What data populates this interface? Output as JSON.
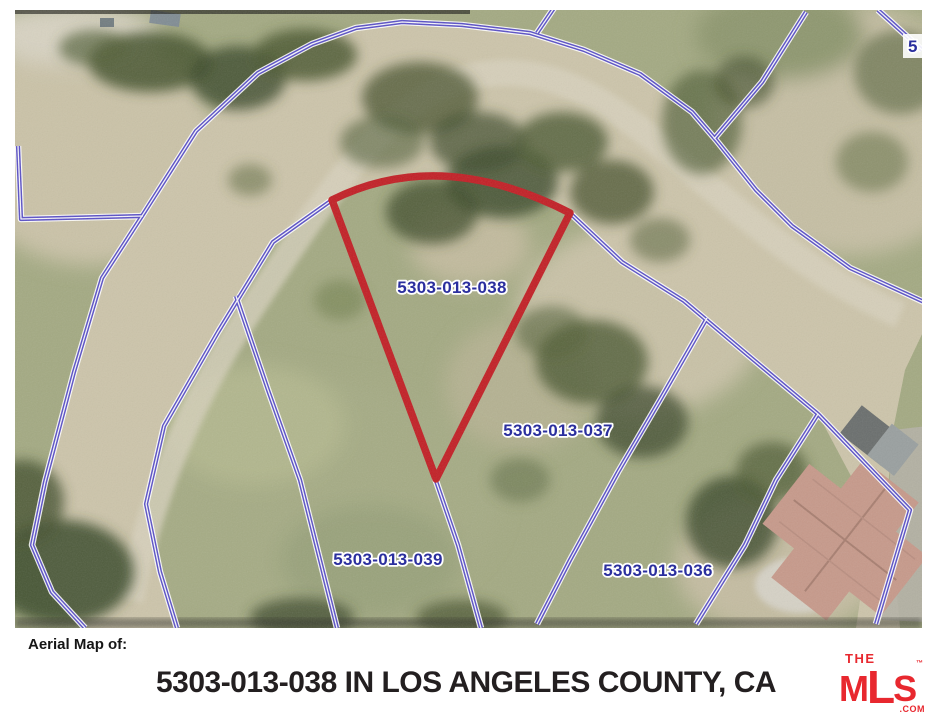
{
  "map": {
    "type": "aerial-parcel-map",
    "highlighted_parcel": "5303-013-038",
    "parcel_labels": [
      {
        "text": "5303-013-038",
        "highlighted": true
      },
      {
        "text": "5303-013-037",
        "highlighted": false
      },
      {
        "text": "5303-013-039",
        "highlighted": false
      },
      {
        "text": "5303-013-036",
        "highlighted": false
      },
      {
        "text": "5",
        "partial": true
      }
    ]
  },
  "footer": {
    "caption": "Aerial Map of:",
    "title": "5303-013-038 IN LOS ANGELES COUNTY, CA"
  },
  "logo": {
    "line1": "THE",
    "m": "M",
    "l": "L",
    "s": "S",
    "tm": "™",
    "suffix": ".COM"
  },
  "colors": {
    "parcel_line": "#5a50c6",
    "highlight_outline": "#c22026",
    "parcel_label": "#2b2f9e",
    "title_text": "#231f20",
    "logo_red": "#e8282f",
    "road": "#cdc5ab",
    "grass": "#a4aa83"
  }
}
